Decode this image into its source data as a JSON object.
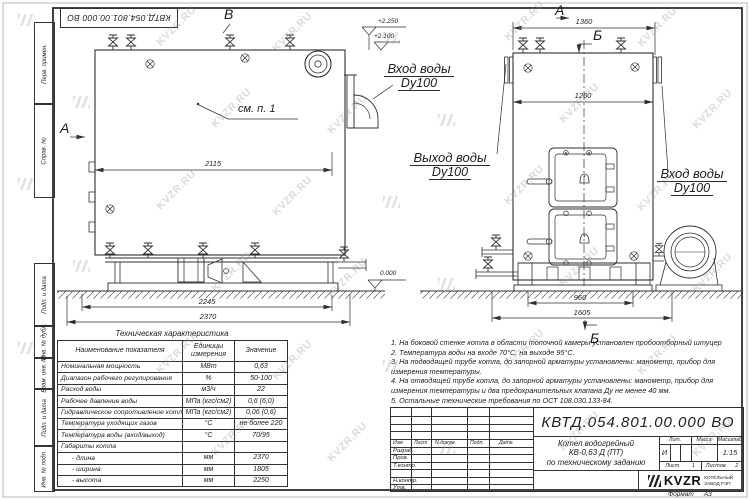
{
  "watermark": {
    "text": "KVZR.RU"
  },
  "corner_stamp": "КВТД.054.801.00.000 ВО",
  "margin_labels": {
    "top": [
      "Перв. примен.",
      "Справ. №"
    ],
    "bottom": [
      "Подп. и дата",
      "Инв. № дубл.",
      "Взам. инв. №",
      "Подп. и дата",
      "Инв. № подл."
    ]
  },
  "drawing": {
    "view_labels": {
      "a_left": "А",
      "v_top": "В",
      "a_right": "А",
      "b_top": "Б",
      "b_bottom": "Б"
    },
    "callout": "см. п. 1",
    "elevations": {
      "e2250": "+2.250",
      "e2100": "+2.100",
      "e0": "0.000"
    },
    "dims": {
      "d2115": "2115",
      "d2245": "2245",
      "d2370": "2370",
      "d1360": "1360",
      "d1260": "1260",
      "d960": "960",
      "d1605": "1605"
    },
    "ports": {
      "inlet_left": {
        "line1": "Вход воды",
        "line2": "Dy100"
      },
      "outlet": {
        "line1": "Выход воды",
        "line2": "Dy100"
      },
      "inlet_right": {
        "line1": "Вход воды",
        "line2": "Dy100"
      }
    }
  },
  "tech_table": {
    "title": "Техническая характеристика",
    "headers": [
      "Наименование показателя",
      "Единицы измерения",
      "Значение"
    ],
    "rows": [
      [
        "Номинальная мощность",
        "МВт",
        "0,63"
      ],
      [
        "Диапазон рабочего регулирования",
        "%",
        "50-100"
      ],
      [
        "Расход воды",
        "м3/ч",
        "22"
      ],
      [
        "Рабочее давление воды",
        "МПа (кгс/см2)",
        "0,6 (6,0)"
      ],
      [
        "Гидравлическое сопротивление котла",
        "МПа (кгс/см2)",
        "0,06 (0,6)"
      ],
      [
        "Температура уходящих газов",
        "°С",
        "не более 220"
      ],
      [
        "Температура воды (вход/выход)",
        "°С",
        "70/95"
      ],
      [
        "Габариты котла",
        "",
        ""
      ],
      [
        "- длина",
        "мм",
        "2370"
      ],
      [
        "- ширина",
        "мм",
        "1805"
      ],
      [
        "- высота",
        "мм",
        "2250"
      ]
    ]
  },
  "notes": [
    "1.  На боковой стенке котла в области топочной камеры установлен пробоотборный штуцер",
    "2.  Температура воды на входе  70°С, на выходе  95°С.",
    "3.  На подводящей трубе котла, до запорной арматуры установлены: манометр, прибор для",
    "измерения температуры.",
    "4.  На отводящей трубе котла, до запорной арматуры установлены: манометр, прибор для",
    "измерения температуры и два предохранительных клапана  Ду не менее  40 мм.",
    "5.  Остальные технические требования по ОСТ  108.030.133-84."
  ],
  "title_block": {
    "doc_number": "КВТД.054.801.00.000  ВО",
    "change_header": [
      "Изм",
      "Лист",
      "N докум.",
      "Подп.",
      "Дата"
    ],
    "sign_rows": [
      "Разраб.",
      "Пров.",
      "Т.контр.",
      "Н.контр.",
      "Утв."
    ],
    "product": [
      "Котел водогрейный",
      "КВ-0,63 Д (ПТ)",
      "по техническому заданию"
    ],
    "lit_header": "Лит.",
    "mass_header": "Масса",
    "scale_header": "Масштаб",
    "lit_value": "И",
    "scale_value": "1:15",
    "sheet_label": "Лист",
    "sheet_value": "1",
    "sheets_label": "Листов",
    "sheets_value": "2",
    "company": {
      "logo": "KVZR",
      "name1": "КОТЕЛЬНЫЙ",
      "name2": "ЗАВОД РЭП"
    },
    "format_label": "Формат",
    "format_value": "А3"
  }
}
